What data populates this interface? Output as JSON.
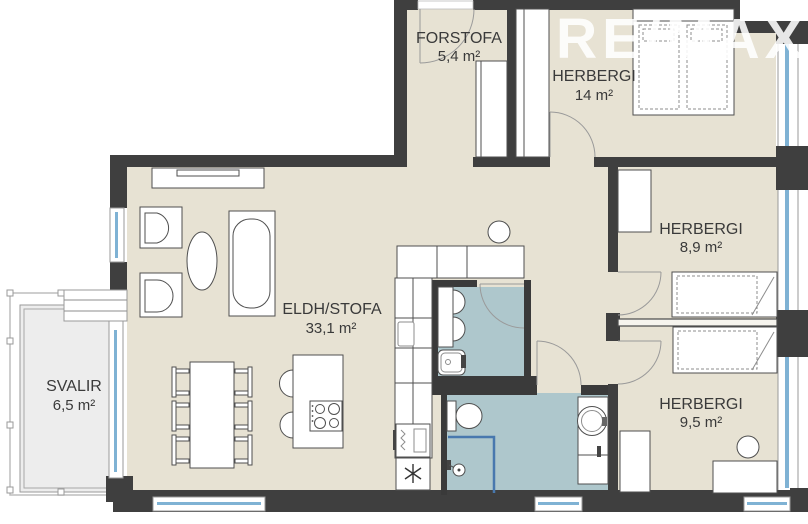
{
  "watermark": {
    "text": "RE/MAX"
  },
  "rooms": {
    "forstofa": {
      "name": "FORSTOFA",
      "area": "5,4 m²",
      "fixtures": [
        "entrance-door",
        "closet"
      ]
    },
    "herbergi14": {
      "name": "HERBERGI",
      "area": "14 m²",
      "fixtures": [
        "double-bed",
        "wardrobe",
        "door"
      ]
    },
    "herbergi89": {
      "name": "HERBERGI",
      "area": "8,9 m²",
      "fixtures": [
        "single-bed",
        "wardrobe",
        "door"
      ]
    },
    "herbergi95": {
      "name": "HERBERGI",
      "area": "9,5 m²",
      "fixtures": [
        "single-bed",
        "desk",
        "stool",
        "dresser",
        "door"
      ]
    },
    "eldhus_stofa": {
      "name": "ELDH/STOFA",
      "area": "33,1 m²",
      "fixtures": [
        "sofa",
        "armchairs",
        "coffee-table",
        "sideboard",
        "dining-table",
        "chairs",
        "kitchen-island",
        "cooktop",
        "oven",
        "dishwasher",
        "counter"
      ]
    },
    "svalir": {
      "name": "SVALIR",
      "area": "6,5 m²",
      "fixtures": [
        "railing",
        "balcony-door"
      ]
    },
    "wc": {
      "name": "",
      "area": "",
      "fixtures": [
        "sink",
        "cabinet",
        "door"
      ]
    },
    "bathroom": {
      "name": "",
      "area": "",
      "fixtures": [
        "toilet",
        "shower",
        "vanity-basin",
        "window"
      ]
    }
  },
  "colors": {
    "floor": "#e7e2d3",
    "wet_room": "#aec7cc",
    "balcony": "#ededed",
    "wall": "#3f3f3f",
    "glazing": "#7fb2d4",
    "shower_line": "#4878ae",
    "text": "#3a3a3a",
    "watermark": "#ffffff"
  }
}
